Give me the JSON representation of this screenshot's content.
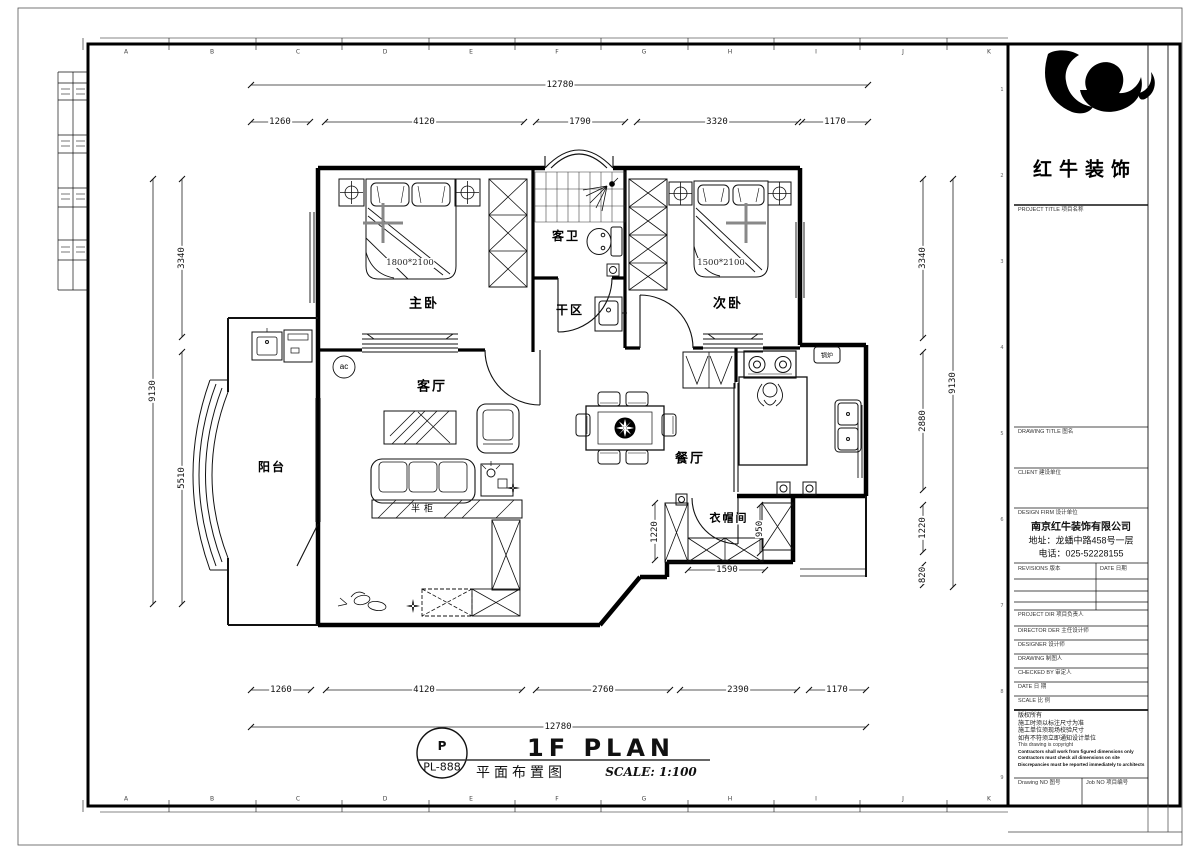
{
  "sheet": {
    "grid_letters_top": [
      "A",
      "B",
      "C",
      "D",
      "E",
      "F",
      "G",
      "H",
      "I",
      "J",
      "K"
    ],
    "grid_letters_bottom": [
      "A",
      "B",
      "C",
      "D",
      "E",
      "F",
      "G",
      "H",
      "I",
      "J",
      "K"
    ],
    "grid_numbers_right": [
      "1",
      "2",
      "3",
      "4",
      "5",
      "6",
      "7",
      "8",
      "9"
    ]
  },
  "plan": {
    "rooms": {
      "master_bedroom": "主卧",
      "second_bedroom": "次卧",
      "guest_bathroom": "客卫",
      "dry_area": "干区",
      "living_room": "客厅",
      "dining_room": "餐厅",
      "balcony": "阳台",
      "cloakroom": "衣帽间"
    },
    "annotations": {
      "master_bed_size": "1800*2100",
      "second_bed_size": "1500*2100",
      "half_cabinet": "半柜",
      "boiler": "锅炉",
      "ac_unit": "ac"
    },
    "dimensions": {
      "top_overall": "12780",
      "top_segments": [
        "1260",
        "4120",
        "1790",
        "3320",
        "1170"
      ],
      "bottom_segments": [
        "1260",
        "4120",
        "2760",
        "2390",
        "1170"
      ],
      "bottom_overall": "12780",
      "left_overall": "9130",
      "left_segments": [
        "3340",
        "5510"
      ],
      "right_segments": [
        "3340",
        "2880",
        "1220",
        "820"
      ],
      "right_overall": "9130",
      "cloak_left": "1220",
      "cloak_right": "950",
      "cloak_bottom": "1590"
    }
  },
  "footer": {
    "code_letter": "P",
    "code": "PL-888",
    "title_en": "1F PLAN",
    "title_cn": "平面布置图",
    "scale": "SCALE: 1:100"
  },
  "titleblock": {
    "company": "红牛装饰",
    "project_title": "PROJECT TITLE  项目名称",
    "drawing_title": "DRAWING TITLE  图名",
    "client": "CLIENT  建设单位",
    "design_firm": "DESIGN FIRM  设计单位",
    "firm_name": "南京红牛装饰有限公司",
    "firm_address": "地址：龙蟠中路458号一层",
    "firm_phone": "电话：025-52228155",
    "revisions": "REVISIONS  版本",
    "date_col": "DATE  日期",
    "project_director": "PROJECT DIR  项目负责人",
    "chief_designer": "DIRECTOR DER  主任设计师",
    "designer": "DESIGNER  设计师",
    "drafter": "DRAWING  制图人",
    "checked_by": "CHECKED BY  审定人",
    "date_row": "DATE  日  期",
    "scale_row": "SCALE  比  例",
    "copyright_cn": [
      "版权所有",
      "施工时须以标注尺寸为准",
      "施工单位须现场校验尺寸",
      "如有不符须立即通知设计单位"
    ],
    "copyright_en": [
      "This drawing is copyright",
      "Contractors shall work from figured dimensions only",
      "Contractors must check all dimensions on site",
      "Discrepancies must be reported immediately to architects"
    ],
    "drawing_no": "Drawing NO  图号",
    "job_no": "Job NO  项目编号"
  }
}
